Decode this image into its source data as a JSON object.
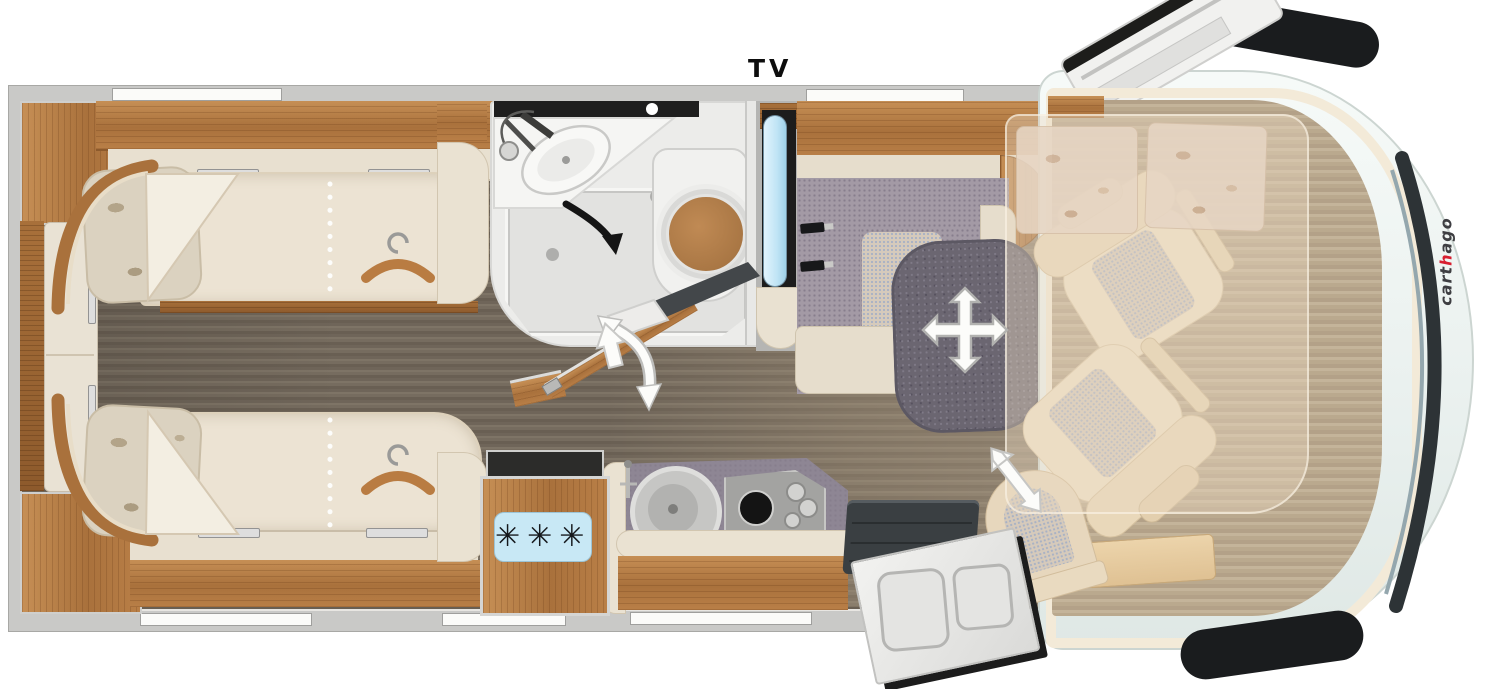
{
  "labels": {
    "tv": "TV"
  },
  "brand": {
    "logo_part1": "cart",
    "logo_accent": "h",
    "logo_part2": "ago"
  },
  "fridge": {
    "frost_symbols": "✳✳✳"
  },
  "colors": {
    "wall_gray": "#c9c9c7",
    "cabinet_wood": "#b5804a",
    "floor_dark": "#756b5e",
    "floor_cab": "#bcab90",
    "upholstery_cream": "#ece3d3",
    "dinette_purple": "#a39aa5",
    "table_gray": "#6b6671",
    "tv_screen_blue": "#bfe4f5",
    "fridge_panel_blue": "#c8e8f5",
    "toilet_seat_wood": "#b5804a",
    "cab_body_white": "#f4f8f6",
    "windshield_dark": "#2d3336",
    "step_mat_dark": "#3a3f42",
    "logo_red": "#d81e30",
    "arrow_white": "#fcfcfa"
  },
  "icons": [
    "hanger-icon",
    "four-way-move-arrow-icon",
    "shower-swivel-arrow-icon",
    "partition-swing-arrow-icon",
    "entry-up-arrow-icon",
    "seat-slide-arrow-icon",
    "snowflake-symbols",
    "tv-screen",
    "skylight-open",
    "wiper-blade"
  ]
}
